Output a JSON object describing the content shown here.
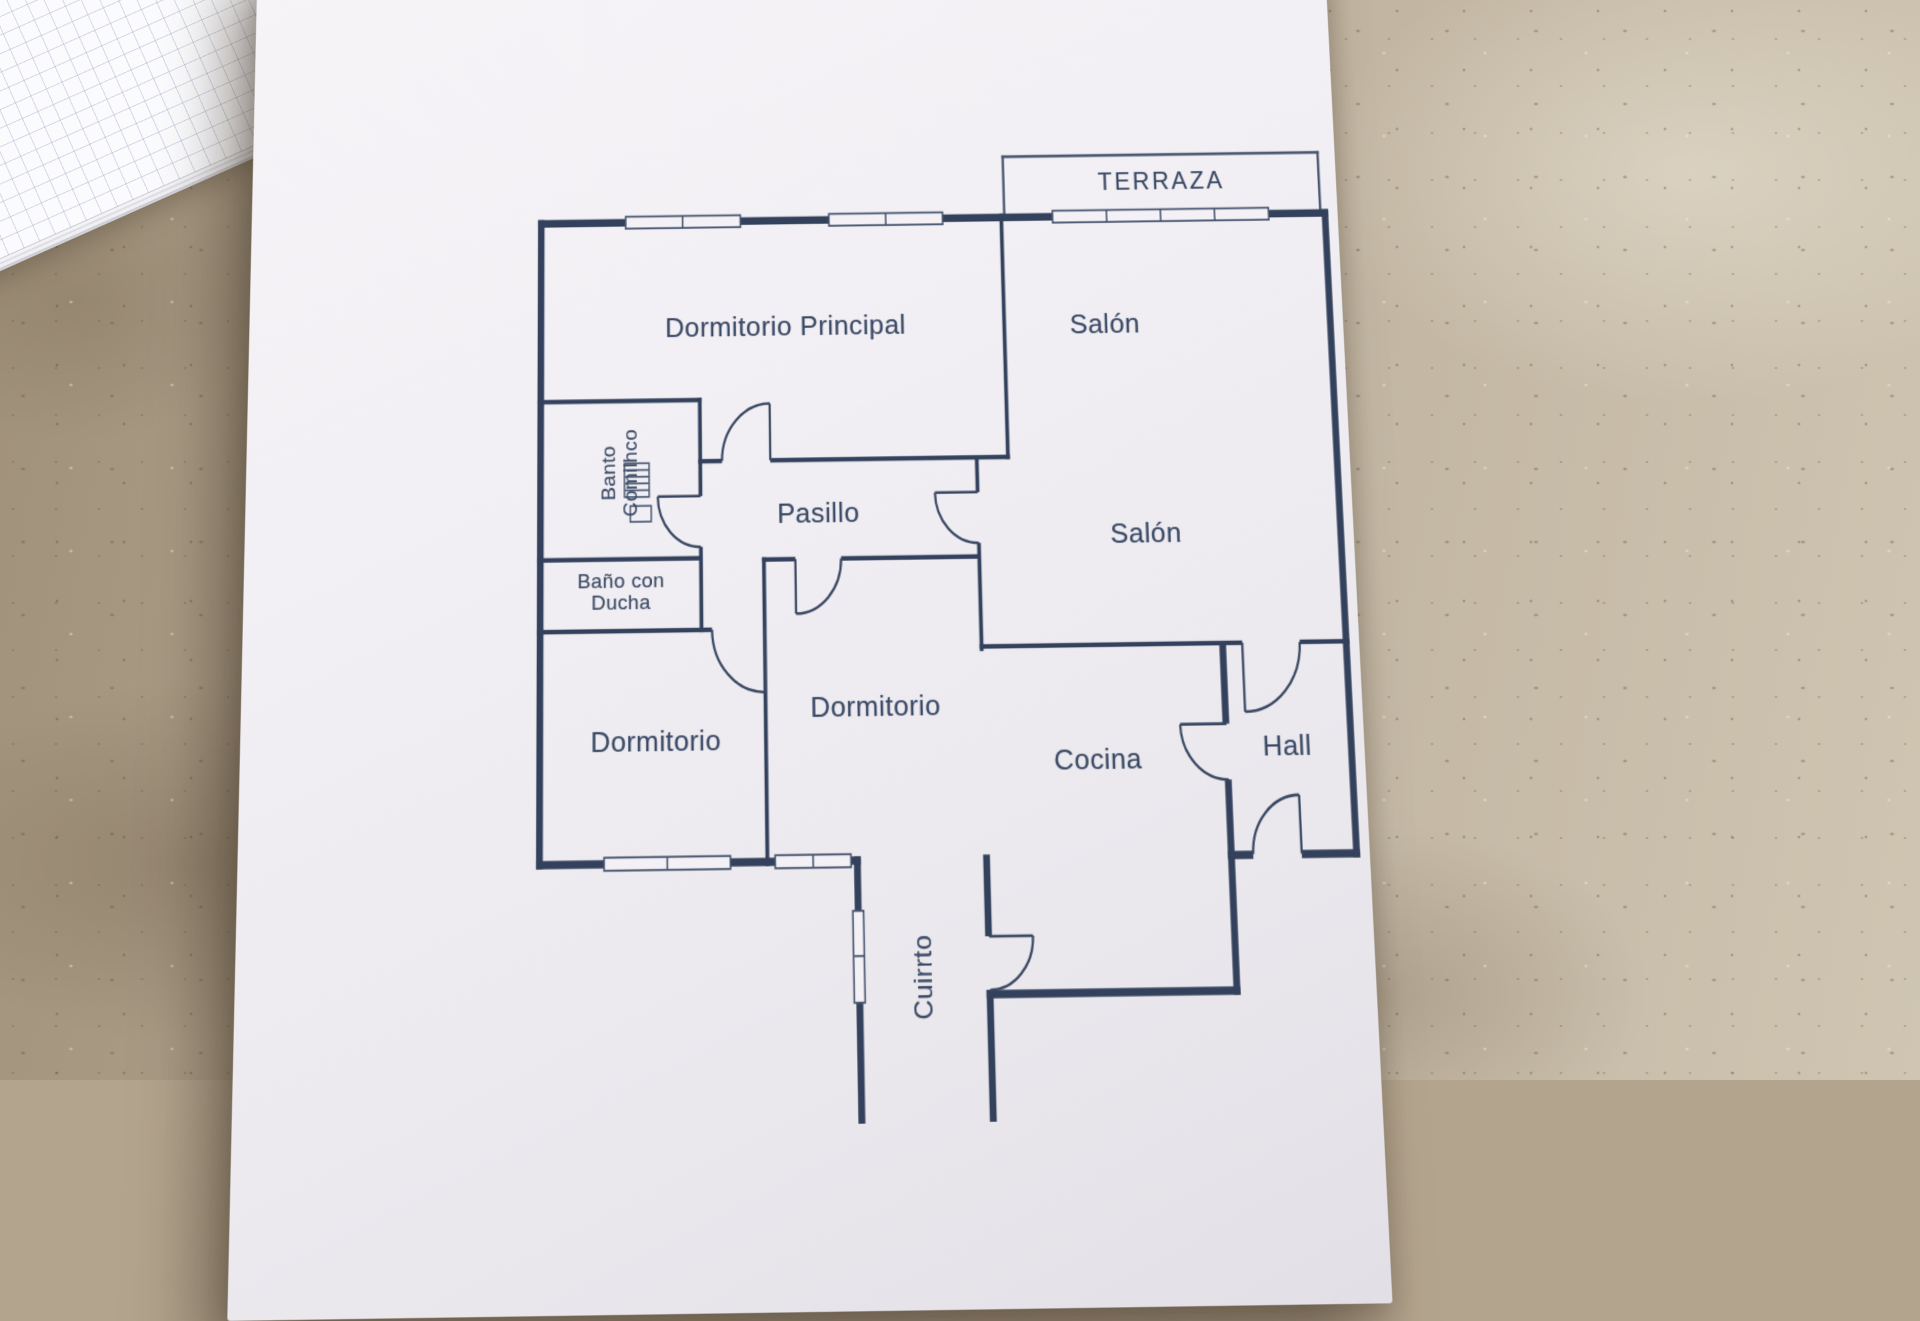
{
  "floor_plan": {
    "rooms": {
      "terraza": {
        "label": "TERRAZA"
      },
      "dormitorio_principal": {
        "label": "Dormitorio Principal"
      },
      "salon_upper": {
        "label": "Salón"
      },
      "salon_lower": {
        "label": "Salón"
      },
      "bano_1": {
        "line1": "Banto",
        "line2": "Comilhco"
      },
      "bano_ducha": {
        "line1": "Baño con",
        "line2": "Ducha"
      },
      "pasillo": {
        "label": "Pasillo"
      },
      "dormitorio_left": {
        "label": "Dormitorio"
      },
      "dormitorio_middle": {
        "label": "Dormitorio"
      },
      "cocina": {
        "label": "Cocina"
      },
      "hall": {
        "label": "Hall"
      },
      "cuarto": {
        "label": "Cuirrto"
      }
    },
    "colors": {
      "ink": "#33415c",
      "paper": "#f2f0f4",
      "countertop": "#b3a48d"
    }
  }
}
